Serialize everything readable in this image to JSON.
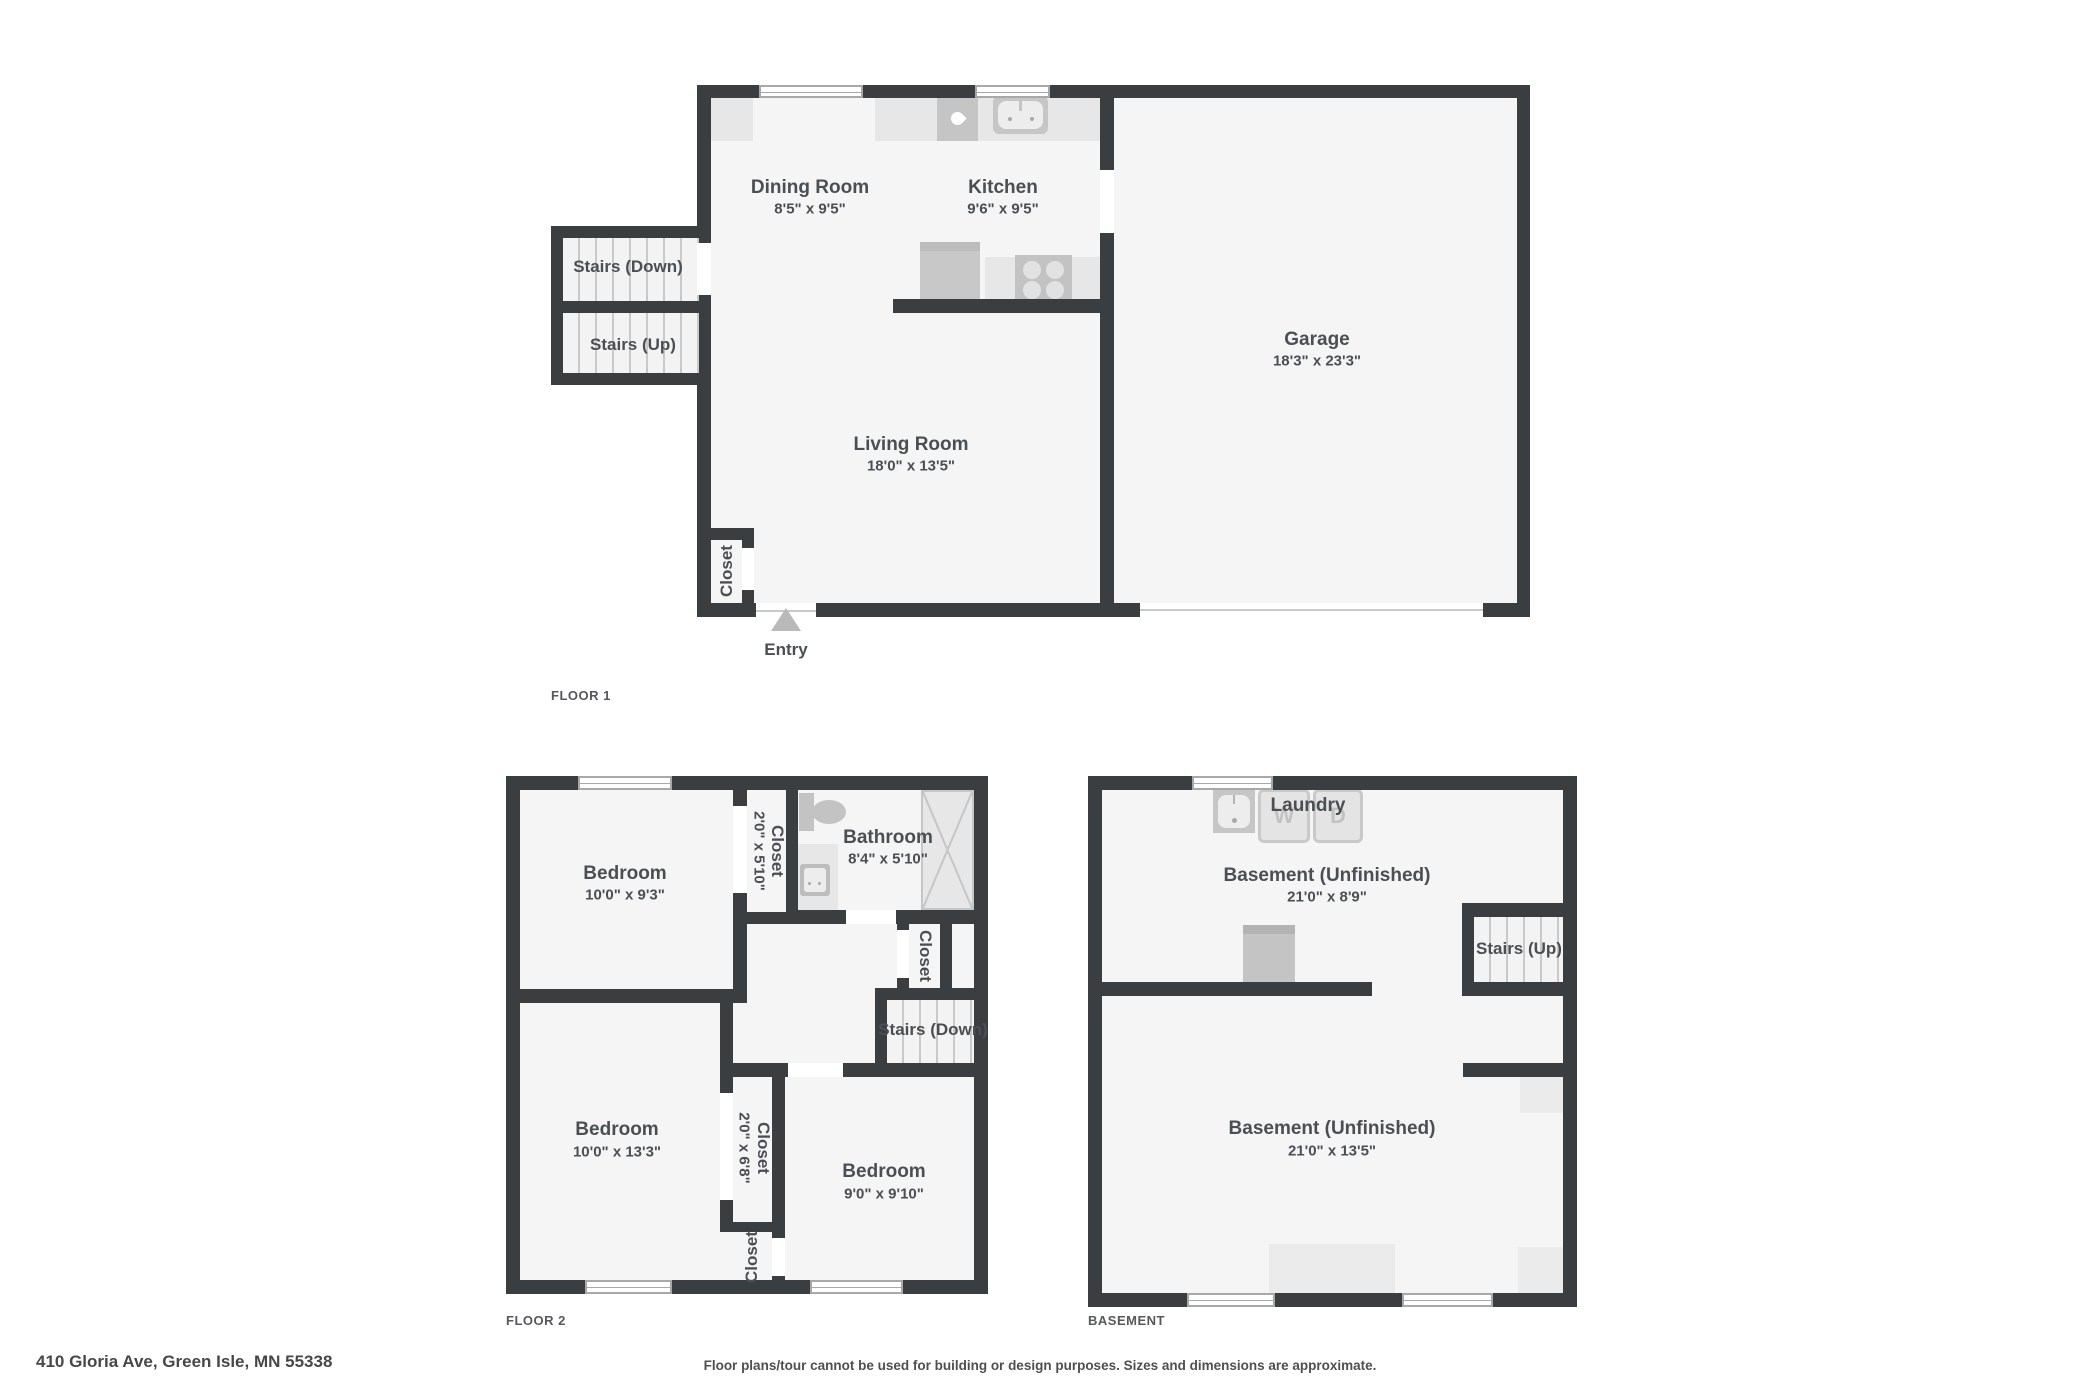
{
  "colors": {
    "wall": "#3b3e41",
    "room_fill": "#f5f5f6",
    "fixture": "#c5c5c5",
    "fixture_light": "#e7e7e8",
    "text": "#4b4f54"
  },
  "floor1": {
    "label": "FLOOR 1",
    "dining": {
      "name": "Dining Room",
      "dims": "8'5\" x 9'5\""
    },
    "kitchen": {
      "name": "Kitchen",
      "dims": "9'6\" x 9'5\""
    },
    "garage": {
      "name": "Garage",
      "dims": "18'3\" x 23'3\""
    },
    "living": {
      "name": "Living Room",
      "dims": "18'0\" x 13'5\""
    },
    "stairs_down": {
      "name": "Stairs (Down)"
    },
    "stairs_up": {
      "name": "Stairs (Up)"
    },
    "closet": {
      "name": "Closet"
    },
    "entry": {
      "name": "Entry"
    }
  },
  "floor2": {
    "label": "FLOOR 2",
    "bedroom1": {
      "name": "Bedroom",
      "dims": "10'0\" x 9'3\""
    },
    "closet1": {
      "name": "Closet",
      "dims": "2'0\" x 5'10\""
    },
    "bathroom": {
      "name": "Bathroom",
      "dims": "8'4\" x 5'10\""
    },
    "closet2": {
      "name": "Closet"
    },
    "stairs_down": {
      "name": "Stairs (Down)"
    },
    "bedroom2": {
      "name": "Bedroom",
      "dims": "10'0\" x 13'3\""
    },
    "closet3": {
      "name": "Closet",
      "dims": "2'0\" x 6'8\""
    },
    "bedroom3": {
      "name": "Bedroom",
      "dims": "9'0\" x 9'10\""
    },
    "closet4": {
      "name": "Closet"
    }
  },
  "basement": {
    "label": "BASEMENT",
    "laundry": {
      "name": "Laundry",
      "washer": "W",
      "dryer": "D"
    },
    "upper": {
      "name": "Basement (Unfinished)",
      "dims": "21'0\" x 8'9\""
    },
    "stairs_up": {
      "name": "Stairs (Up)"
    },
    "lower": {
      "name": "Basement (Unfinished)",
      "dims": "21'0\" x 13'5\""
    }
  },
  "footer": {
    "address": "410 Gloria Ave, Green Isle, MN 55338",
    "disclaimer": "Floor plans/tour cannot be used for building or design purposes. Sizes and dimensions are approximate."
  }
}
